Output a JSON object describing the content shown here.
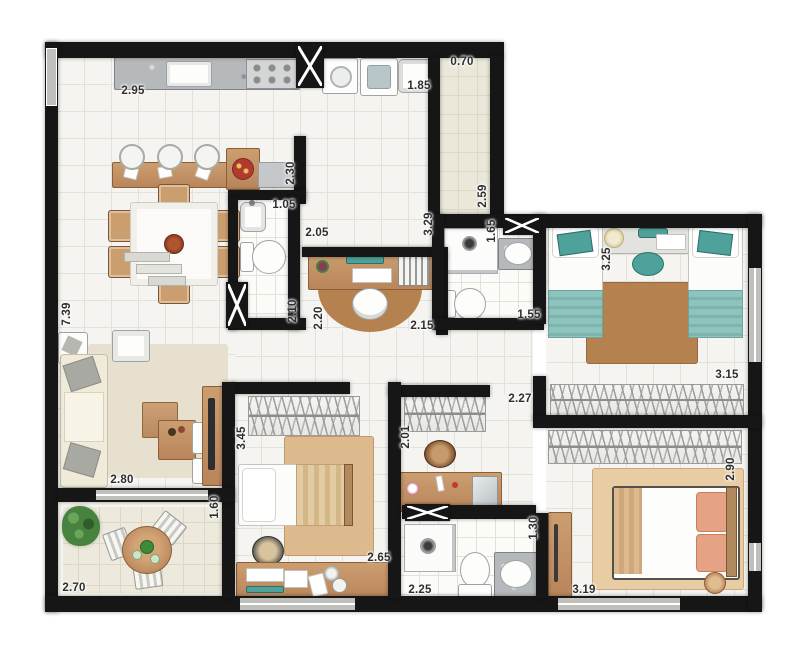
{
  "plan": {
    "dimension_labels": [
      {
        "value": "2.95",
        "x": 133,
        "y": 91,
        "orientation": "horizontal"
      },
      {
        "value": "0.70",
        "x": 462,
        "y": 62,
        "orientation": "horizontal"
      },
      {
        "value": "1.85",
        "x": 419,
        "y": 86,
        "orientation": "horizontal"
      },
      {
        "value": "2.30",
        "x": 291,
        "y": 173,
        "orientation": "vertical"
      },
      {
        "value": "1.05",
        "x": 284,
        "y": 205,
        "orientation": "horizontal"
      },
      {
        "value": "2.05",
        "x": 317,
        "y": 233,
        "orientation": "horizontal"
      },
      {
        "value": "3.29",
        "x": 429,
        "y": 224,
        "orientation": "vertical"
      },
      {
        "value": "2.59",
        "x": 483,
        "y": 196,
        "orientation": "vertical"
      },
      {
        "value": "1.65",
        "x": 492,
        "y": 231,
        "orientation": "vertical"
      },
      {
        "value": "1.55",
        "x": 529,
        "y": 315,
        "orientation": "horizontal"
      },
      {
        "value": "3.25",
        "x": 607,
        "y": 259,
        "orientation": "vertical"
      },
      {
        "value": "2.10",
        "x": 293,
        "y": 311,
        "orientation": "vertical"
      },
      {
        "value": "2.20",
        "x": 319,
        "y": 318,
        "orientation": "vertical"
      },
      {
        "value": "2.15",
        "x": 422,
        "y": 326,
        "orientation": "horizontal"
      },
      {
        "value": "7.39",
        "x": 67,
        "y": 314,
        "orientation": "vertical"
      },
      {
        "value": "2.80",
        "x": 122,
        "y": 480,
        "orientation": "horizontal"
      },
      {
        "value": "1.60",
        "x": 215,
        "y": 507,
        "orientation": "vertical"
      },
      {
        "value": "2.70",
        "x": 74,
        "y": 588,
        "orientation": "horizontal"
      },
      {
        "value": "3.45",
        "x": 242,
        "y": 438,
        "orientation": "vertical"
      },
      {
        "value": "2.65",
        "x": 379,
        "y": 558,
        "orientation": "horizontal"
      },
      {
        "value": "2.01",
        "x": 406,
        "y": 437,
        "orientation": "vertical"
      },
      {
        "value": "2.27",
        "x": 520,
        "y": 399,
        "orientation": "horizontal"
      },
      {
        "value": "3.15",
        "x": 727,
        "y": 375,
        "orientation": "horizontal"
      },
      {
        "value": "2.90",
        "x": 731,
        "y": 469,
        "orientation": "vertical"
      },
      {
        "value": "3.19",
        "x": 584,
        "y": 590,
        "orientation": "horizontal"
      },
      {
        "value": "1.30",
        "x": 534,
        "y": 528,
        "orientation": "vertical"
      },
      {
        "value": "2.25",
        "x": 420,
        "y": 590,
        "orientation": "horizontal"
      }
    ]
  },
  "colors": {
    "wall": "#161617",
    "windowGray": "#bfbfbb",
    "floorTile": "#f5f4f0",
    "grout": "#e3e1db",
    "corridorTile": "#ebe8da",
    "balconyTile": "#edeadd",
    "balconyGrout": "#dcd7c6",
    "wood": "#cb9e70",
    "woodDark": "#b9855a",
    "teal": "#4fa29b",
    "tealLight": "#8fc3bd",
    "rugBrown": "#b5814e",
    "rugTan": "#dcba8e",
    "rugMaster": "#e8cda4",
    "rugLiving": "#e7e0cf",
    "granite": "#b6b9bb",
    "salmon": "#e5a284",
    "plantGreen": "#47823f",
    "cream": "#f0ead9",
    "labelColor": "#2e2e2e"
  }
}
